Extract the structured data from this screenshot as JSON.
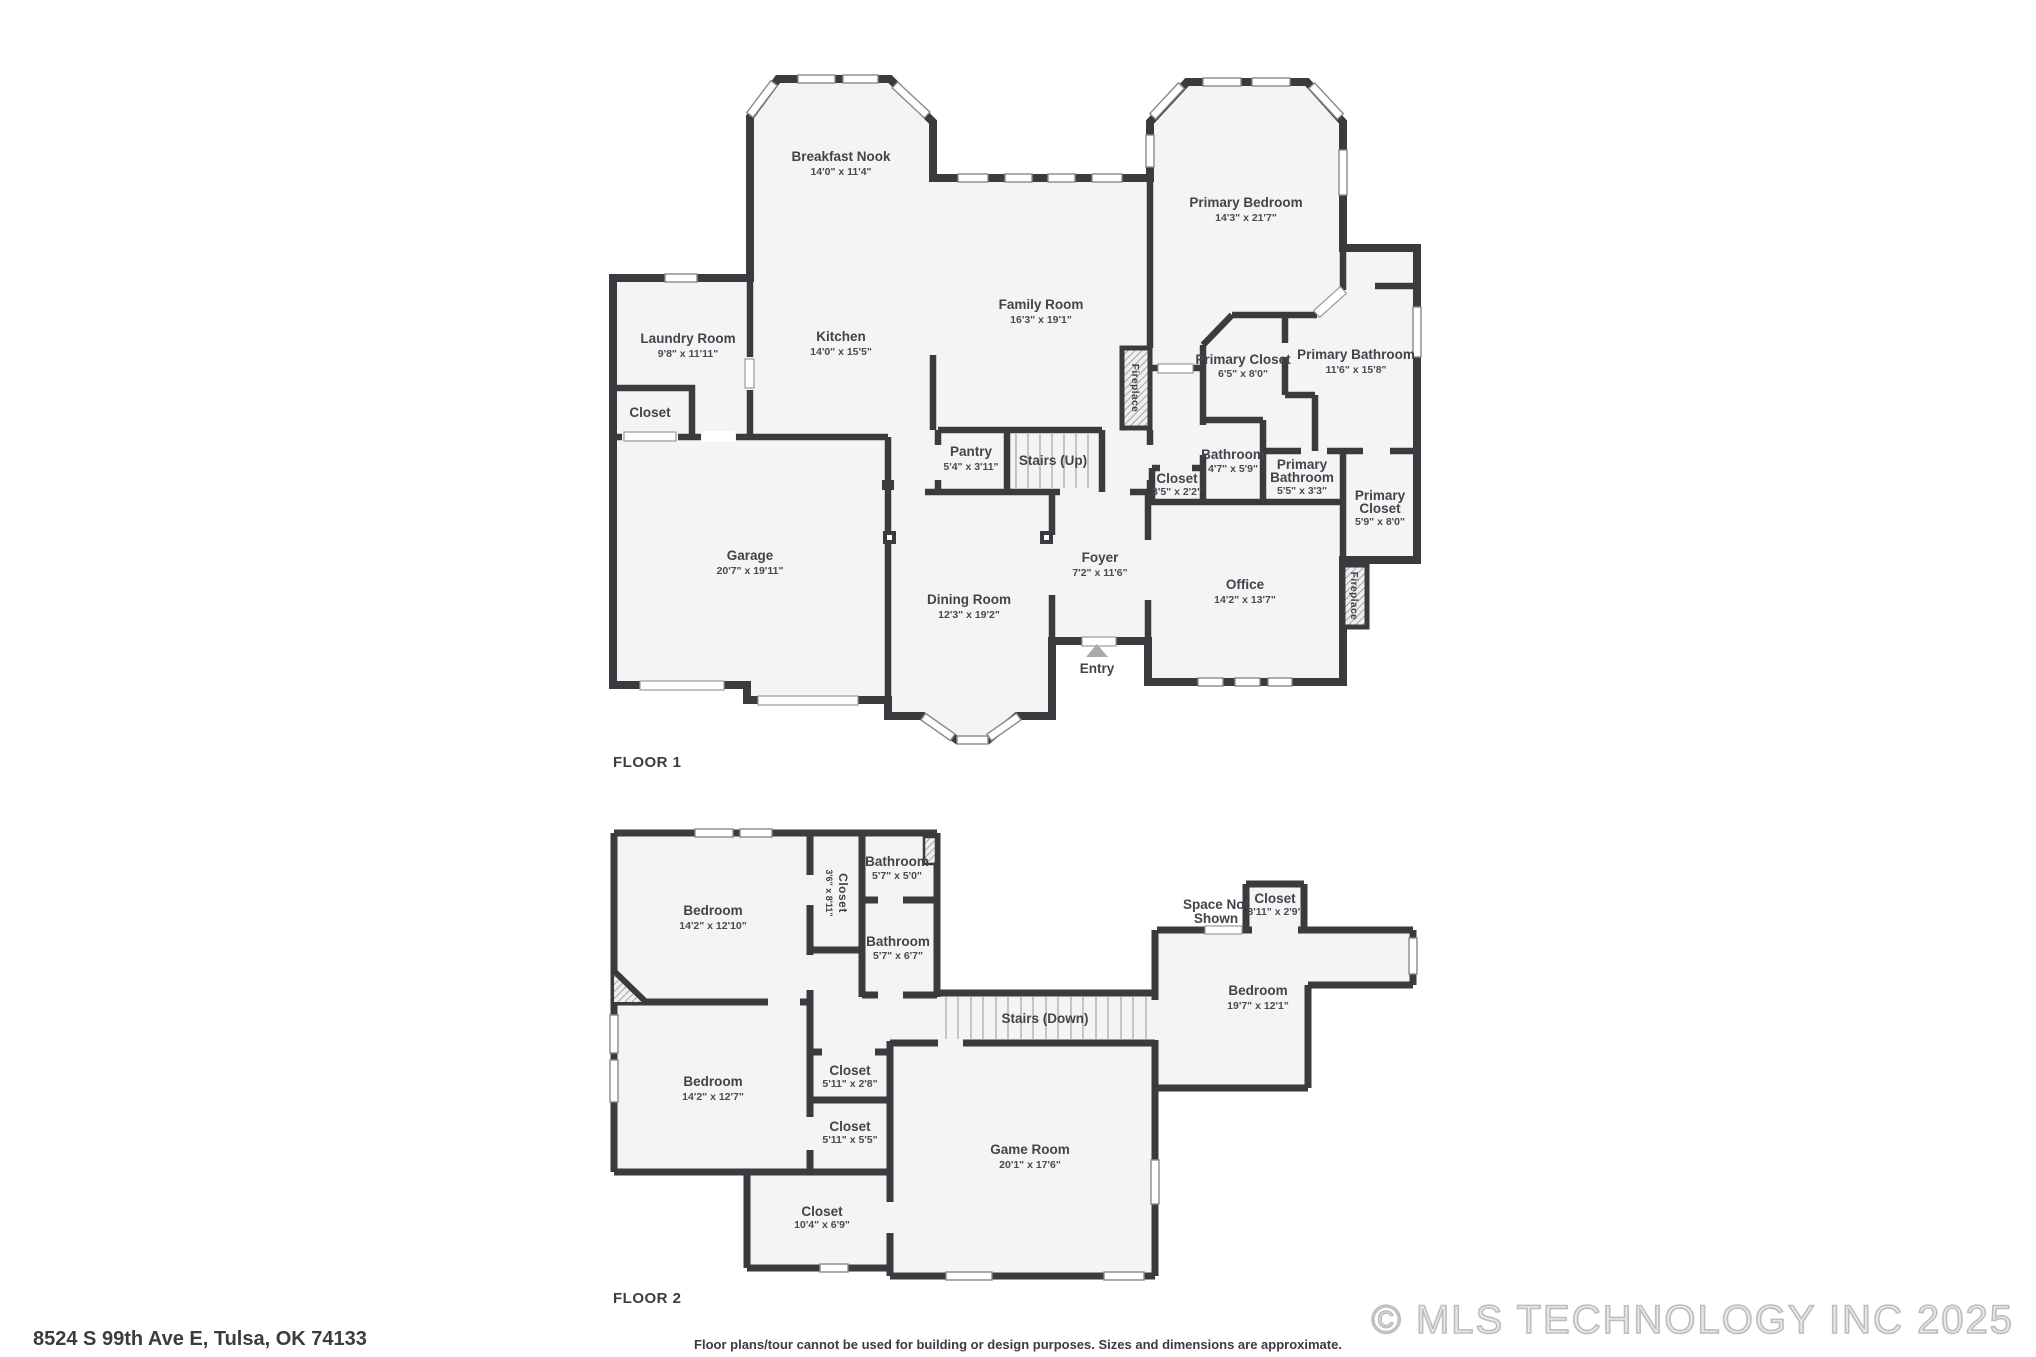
{
  "document": {
    "type": "real-estate floor plan"
  },
  "colors": {
    "wall": "#3a3a3f",
    "room_fill": "#f4f4f5",
    "label_text": "#43434b",
    "thin_line": "#9a9a9a",
    "watermark": "#c9c9c9",
    "background": "#ffffff"
  },
  "floor1": {
    "title": "FLOOR 1",
    "rooms": {
      "breakfastNook": {
        "name": "Breakfast Nook",
        "dims": "14'0\" x 11'4\""
      },
      "primaryBedroom": {
        "name": "Primary Bedroom",
        "dims": "14'3\" x 21'7\""
      },
      "laundryRoom": {
        "name": "Laundry Room",
        "dims": "9'8\" x 11'11\""
      },
      "kitchen": {
        "name": "Kitchen",
        "dims": "14'0\" x 15'5\""
      },
      "familyRoom": {
        "name": "Family Room",
        "dims": "16'3\" x 19'1\""
      },
      "primaryCloset1": {
        "name": "Primary Closet",
        "dims": "6'5\" x 8'0\""
      },
      "primaryBathroom1": {
        "name": "Primary Bathroom",
        "dims": "11'6\" x 15'8\""
      },
      "laundryCloset": {
        "name": "Closet"
      },
      "pantry": {
        "name": "Pantry",
        "dims": "5'4\" x 3'11\""
      },
      "stairsUp": {
        "name": "Stairs (Up)"
      },
      "hallCloset": {
        "name": "Closet",
        "dims": "3'5\" x 2'2\""
      },
      "bathroom": {
        "name": "Bathroom",
        "dims": "4'7\" x 5'9\""
      },
      "primaryBathroom2": {
        "name1": "Primary",
        "name2": "Bathroom",
        "dims": "5'5\" x 3'3\""
      },
      "primaryCloset2": {
        "name1": "Primary",
        "name2": "Closet",
        "dims": "5'9\" x 8'0\""
      },
      "garage": {
        "name": "Garage",
        "dims": "20'7\" x 19'11\""
      },
      "foyer": {
        "name": "Foyer",
        "dims": "7'2\" x 11'6\""
      },
      "diningRoom": {
        "name": "Dining Room",
        "dims": "12'3\" x 19'2\""
      },
      "office": {
        "name": "Office",
        "dims": "14'2\" x 13'7\""
      },
      "entry": {
        "name": "Entry"
      },
      "fireplace1": {
        "name": "Fireplace"
      },
      "fireplace2": {
        "name": "Fireplace"
      }
    }
  },
  "floor2": {
    "title": "FLOOR 2",
    "rooms": {
      "bedroom1": {
        "name": "Bedroom",
        "dims": "14'2\" x 12'10\""
      },
      "closet1": {
        "name": "Closet",
        "dims": "3'6\" x 8'11\""
      },
      "bathroom1": {
        "name": "Bathroom",
        "dims": "5'7\" x 5'0\""
      },
      "bathroom2": {
        "name": "Bathroom",
        "dims": "5'7\" x 6'7\""
      },
      "spaceNotShown": {
        "name1": "Space Not",
        "name2": "Shown"
      },
      "closet2": {
        "name": "Closet",
        "dims": "3'11\" x 2'9\""
      },
      "bedroom2": {
        "name": "Bedroom",
        "dims": "19'7\" x 12'1\""
      },
      "stairsDown": {
        "name": "Stairs (Down)"
      },
      "bedroom3": {
        "name": "Bedroom",
        "dims": "14'2\" x 12'7\""
      },
      "closet3": {
        "name": "Closet",
        "dims": "5'11\" x 2'8\""
      },
      "closet4": {
        "name": "Closet",
        "dims": "5'11\" x 5'5\""
      },
      "gameRoom": {
        "name": "Game Room",
        "dims": "20'1\" x 17'6\""
      },
      "closet5": {
        "name": "Closet",
        "dims": "10'4\" x 6'9\""
      }
    }
  },
  "footer": {
    "address": "8524 S 99th Ave E, Tulsa, OK 74133",
    "disclaimer": "Floor plans/tour cannot be used for building or design purposes. Sizes and dimensions are approximate.",
    "copyright": "© MLS TECHNOLOGY INC 2025"
  }
}
